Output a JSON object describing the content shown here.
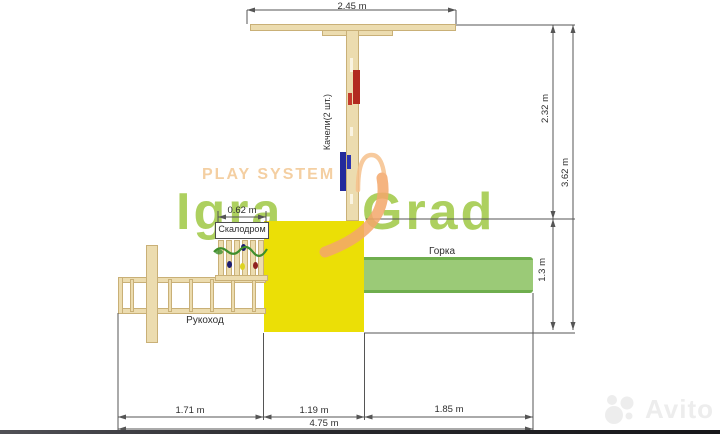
{
  "dimensions": {
    "top_width": "2.45 m",
    "climb_width": "0.62 m",
    "right_upper": "2.32 m",
    "right_total": "3.62 m",
    "right_lower": "1.3 m",
    "bottom_left": "1.71 m",
    "bottom_mid": "1.19 m",
    "bottom_right": "1.85 m",
    "bottom_total": "4.75 m"
  },
  "labels": {
    "climbing_wall": "Скалодром",
    "swings": "Качели(2 шт.)",
    "slide": "Горка",
    "monkey_bars": "Рукоход"
  },
  "watermark": {
    "play_system": "PLAY SYSTEM",
    "brand_left": "Igra",
    "brand_right": "Grad",
    "marketplace": "Avito"
  },
  "colors": {
    "wood": "#ecdcaf",
    "wood_border": "#c9b077",
    "platform_yellow": "#ebdf06",
    "slide_green": "#9bca77",
    "slide_edge": "#6fae4e",
    "swing_red": "#b22a20",
    "swing_red_light": "#c43a2c",
    "swing_blue": "#232a9c",
    "swing_blue_light": "#2b34b0",
    "brand_green": "#9fc844",
    "brand_orange": "#f4cfa2",
    "glyph_orange": "#f4a76b",
    "glyph_orange_light": "#f6c18c",
    "dim_line": "#555555",
    "dim_text": "#2f2f2f",
    "hold_navy": "#1c1c70",
    "hold_yellow": "#ddd321",
    "hold_red": "#8f2020",
    "wall_wave": "#3e8e2c",
    "avito_gray": "#ededed"
  }
}
